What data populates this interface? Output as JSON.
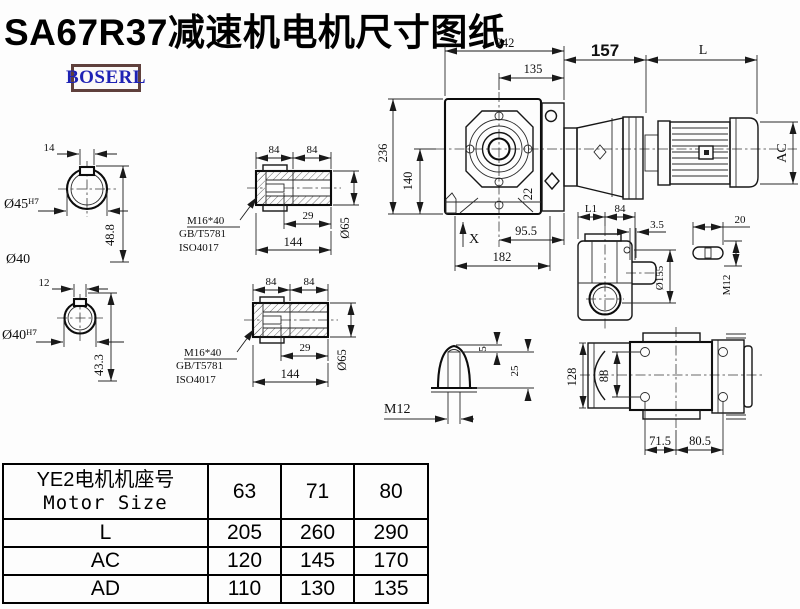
{
  "title": "SA67R37减速机电机尺寸图纸",
  "brand": {
    "logo": "BOSERL"
  },
  "views": {
    "hole_top": {
      "width": "14",
      "bore": "Ø45ᴴ⁷",
      "height": "48.8",
      "outer": "Ø40"
    },
    "hole_bottom": {
      "width": "12",
      "bore": "Ø40ᴴ⁷",
      "height": "43.3"
    },
    "shaft_top": {
      "seg1": "84",
      "seg2": "84",
      "key": "29",
      "total": "144",
      "dia": "Ø65",
      "bolt1": "M16*40",
      "bolt2": "GB/T5781",
      "bolt3": "ISO4017"
    },
    "shaft_bottom": {
      "seg1": "84",
      "seg2": "84",
      "key": "29",
      "total": "144",
      "dia": "Ø65",
      "bolt1": "M16*40",
      "bolt2": "GB/T5781",
      "bolt3": "ISO4017"
    },
    "front": {
      "overall_w": "242",
      "center_to_face": "135",
      "adapter": "157",
      "motor_len": "L",
      "overall_h": "236",
      "axis_h": "140",
      "offset": "22",
      "base1": "95.5",
      "datum": "X",
      "base2": "182",
      "motor_dia": "AC"
    },
    "side": {
      "l1": "L1",
      "w84": "84",
      "plate": "3.5",
      "dia": "Ø155",
      "slot": "20",
      "thread": "M12"
    },
    "key_detail": {
      "tip": "5",
      "depth": "25",
      "thread": "M12"
    },
    "bottom": {
      "h": "128",
      "bolt_span": "88",
      "left": "71.5",
      "right": "80.5"
    }
  },
  "table": {
    "header_cn": "YE2电机机座号",
    "header_en": "Motor Size",
    "sizes": [
      "63",
      "71",
      "80"
    ],
    "rows": [
      {
        "label": "L",
        "values": [
          "205",
          "260",
          "290"
        ]
      },
      {
        "label": "AC",
        "values": [
          "120",
          "145",
          "170"
        ]
      },
      {
        "label": "AD",
        "values": [
          "110",
          "130",
          "135"
        ]
      }
    ]
  }
}
